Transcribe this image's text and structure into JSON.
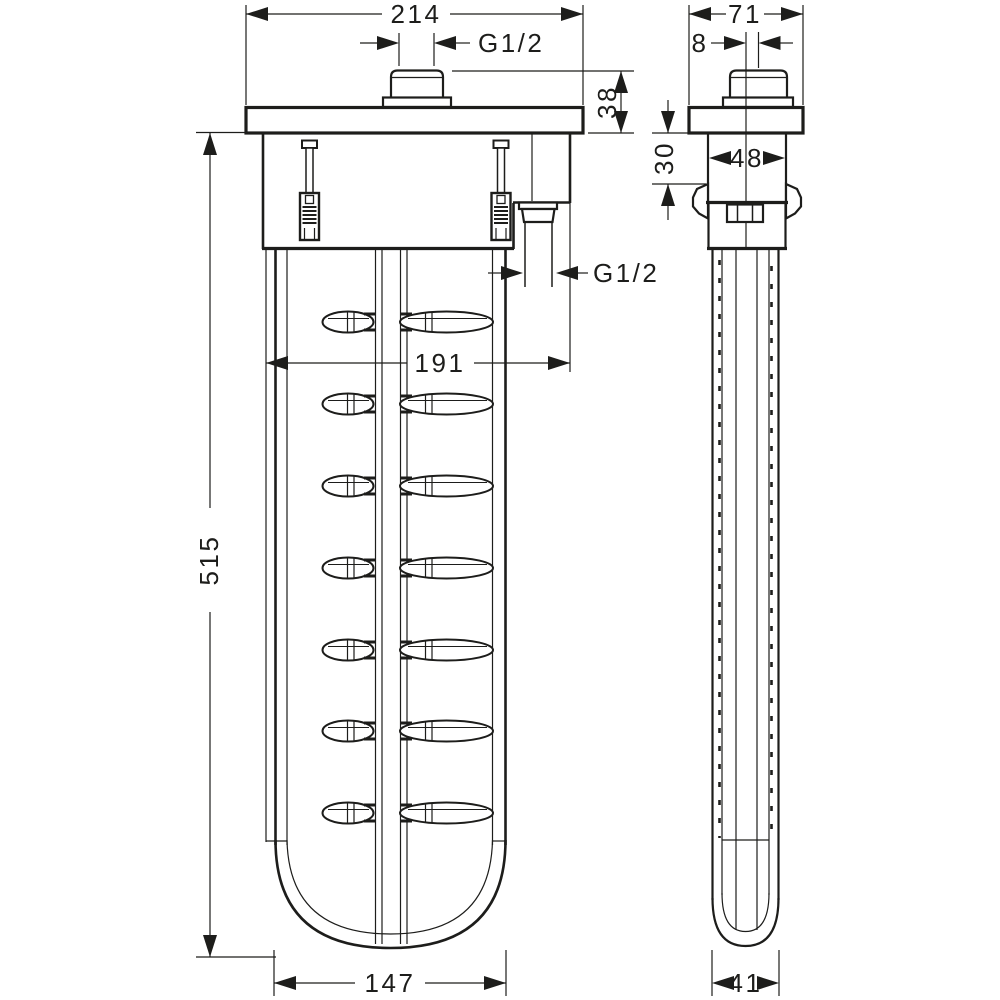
{
  "page": {
    "background": "#ffffff",
    "line_color": "#1d1d1b"
  },
  "dimensions": {
    "front": {
      "overall_width": "214",
      "top_connection_thread": "G1/2",
      "flange_to_connector_height": "38",
      "hose_outlet_thread": "G1/2",
      "outlet_offset_width": "191",
      "overall_height": "515",
      "body_width": "147"
    },
    "side": {
      "overall_depth": "71",
      "connector_offset": "8",
      "flange_to_clip_depth": "30",
      "upper_body_depth": "48",
      "body_depth": "41"
    }
  }
}
